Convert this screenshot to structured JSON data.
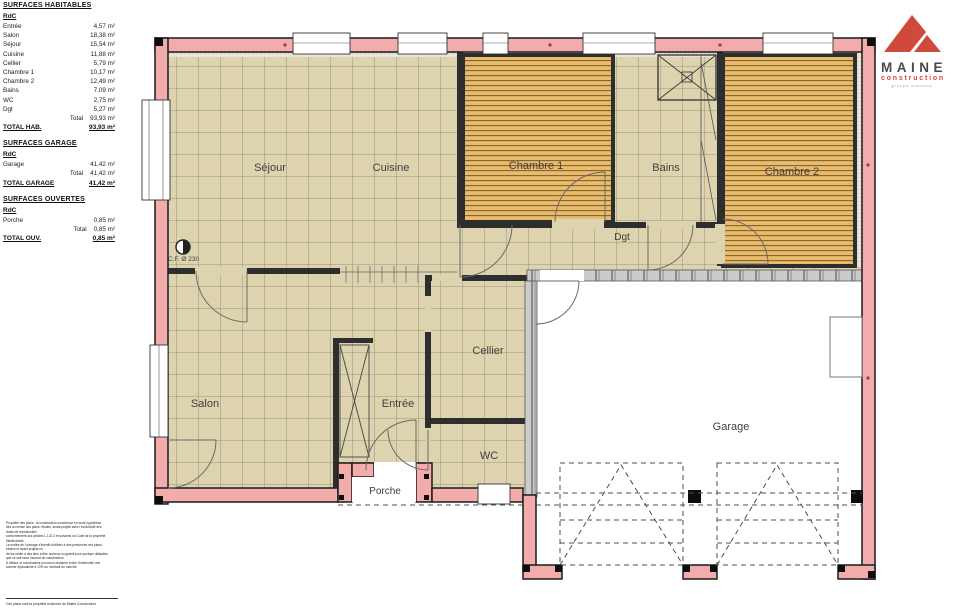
{
  "logo": {
    "name": "MAINE",
    "sub": "construction",
    "tiny": "groupe maisons"
  },
  "legend": {
    "habitables": {
      "title": "SURFACES HABITABLES",
      "level": "RdC",
      "rows": [
        {
          "label": "Entrée",
          "value": "4,57 m²"
        },
        {
          "label": "Salon",
          "value": "18,38 m²"
        },
        {
          "label": "Séjour",
          "value": "15,54 m²"
        },
        {
          "label": "Cuisine",
          "value": "11,88 m²"
        },
        {
          "label": "Cellier",
          "value": "5,79 m²"
        },
        {
          "label": "Chambre 1",
          "value": "10,17 m²"
        },
        {
          "label": "Chambre 2",
          "value": "12,49 m²"
        },
        {
          "label": "Bains",
          "value": "7,09 m²"
        },
        {
          "label": "WC",
          "value": "2,75 m²"
        },
        {
          "label": "Dgt",
          "value": "5,27 m²"
        }
      ],
      "total_label": "Total",
      "total_value": "93,93 m²",
      "grand_label": "TOTAL HAB.",
      "grand_value": "93,93 m²"
    },
    "garage": {
      "title": "SURFACES GARAGE",
      "level": "RdC",
      "rows": [
        {
          "label": "Garage",
          "value": "41,42 m²"
        }
      ],
      "total_label": "Total",
      "total_value": "41,42 m²",
      "grand_label": "TOTAL GARAGE",
      "grand_value": "41,42 m²"
    },
    "ouvertes": {
      "title": "SURFACES OUVERTES",
      "level": "RdC",
      "rows": [
        {
          "label": "Porche",
          "value": "0,85 m²"
        }
      ],
      "total_label": "Total",
      "total_value": "0,85 m²",
      "grand_label": "TOTAL OUV.",
      "grand_value": "0,85 m²"
    }
  },
  "plan": {
    "rooms": {
      "sejour": "Séjour",
      "cuisine": "Cuisine",
      "chambre1": "Chambre 1",
      "bains": "Bains",
      "chambre2": "Chambre 2",
      "dgt": "Dgt",
      "salon": "Salon",
      "entree": "Entrée",
      "cellier": "Cellier",
      "wc": "WC",
      "porche": "Porche",
      "garage": "Garage"
    },
    "cf_label": "C.F. Ø 230"
  },
  "fineprint": {
    "lines": [
      "Propriété des plans : la construction commence en toute hypothèse",
      "dès la remise des plans, études, avant-projets avec l'exclusivité des",
      "droits de reproduction",
      "conformément aux articles L.122-4 et suivants du Code de la propriété",
      "intellectuelle.",
      "Le maître de l'ouvrage s'interdit d'utiliser à des personnes ces plans,",
      "études et avant-projets ou",
      "de les céder à des tiers à titre onéreux ou gratuit pour quelque utilisation",
      "que ce soit sans l'accord du constructeur.",
      "À défaut, le constructeur pourra lui réclamer à titre d'indemnité une",
      "somme équivalente à 10% du montant du marché."
    ],
    "footer": "Ces plans sont la propriété exclusive de Maine Construction"
  },
  "colors": {
    "wall_pink": "#f2acac",
    "tile_beige": "#ddd3ae",
    "wood_orange": "#e9bb6d",
    "logo_red": "#cf4a3c"
  }
}
